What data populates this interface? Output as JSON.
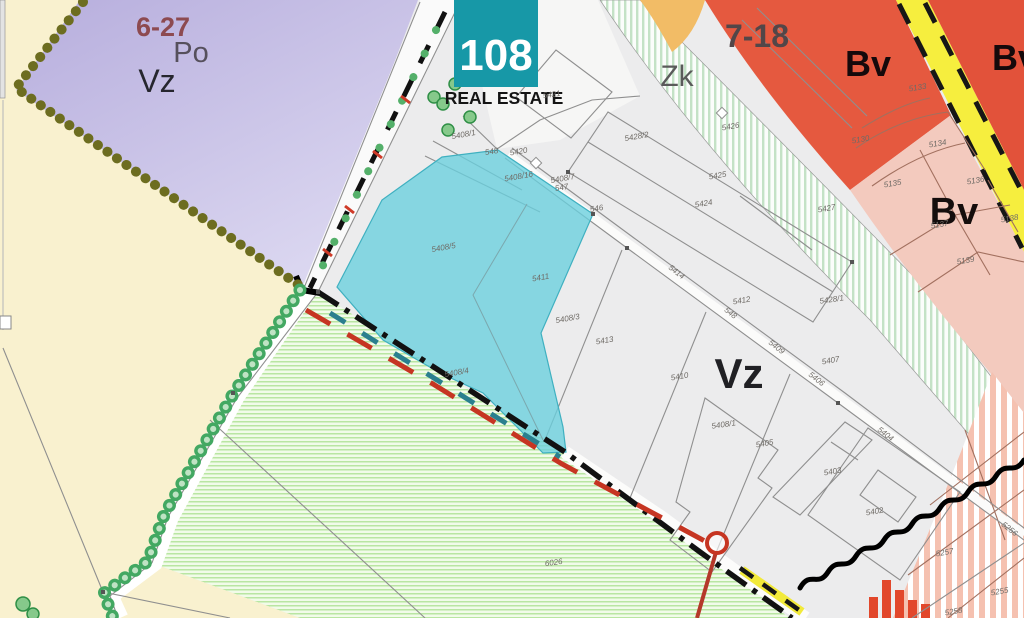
{
  "logo": {
    "number": "108",
    "name": "REAL ESTATE"
  },
  "zone_labels": [
    {
      "id": "zone-label-6-27",
      "text": "6-27",
      "x": 163,
      "y": 36,
      "s": 27,
      "w": 700,
      "c": "#8d4a50"
    },
    {
      "id": "zone-label-po",
      "text": "Po",
      "x": 191,
      "y": 62,
      "s": 29,
      "w": 400,
      "c": "#56505c"
    },
    {
      "id": "zone-label-vz-left",
      "text": "Vz",
      "x": 157,
      "y": 92,
      "s": 32,
      "w": 400,
      "c": "#26262e"
    },
    {
      "id": "zone-label-zk",
      "text": "Zk",
      "x": 677,
      "y": 86,
      "s": 30,
      "w": 400,
      "c": "#5a5a5a"
    },
    {
      "id": "zone-label-7-18",
      "text": "7-18",
      "x": 757,
      "y": 47,
      "s": 32,
      "w": 600,
      "c": "#534648"
    },
    {
      "id": "zone-label-bv-top",
      "text": "Bv",
      "x": 868,
      "y": 76,
      "s": 36,
      "w": 600,
      "c": "#15090b"
    },
    {
      "id": "zone-label-bv-right",
      "text": "Bv",
      "x": 1015,
      "y": 70,
      "s": 36,
      "w": 600,
      "c": "#15090b"
    },
    {
      "id": "zone-label-bv-pink",
      "text": "Bv",
      "x": 954,
      "y": 224,
      "s": 38,
      "w": 600,
      "c": "#140d0c"
    },
    {
      "id": "zone-label-vz-main",
      "text": "Vz",
      "x": 739,
      "y": 388,
      "s": 42,
      "w": 600,
      "c": "#202024"
    }
  ],
  "parcels": [
    {
      "id": "5421",
      "x": 552,
      "y": 97,
      "r": -8
    },
    {
      "id": "5408/1",
      "x": 464,
      "y": 137,
      "r": -10
    },
    {
      "id": "548",
      "x": 492,
      "y": 154,
      "r": -10
    },
    {
      "id": "5420",
      "x": 519,
      "y": 154,
      "r": -10
    },
    {
      "id": "5408/16",
      "x": 519,
      "y": 179,
      "r": -10
    },
    {
      "id": "5408/7",
      "x": 563,
      "y": 181,
      "r": -10
    },
    {
      "id": "547",
      "x": 562,
      "y": 190,
      "r": -10
    },
    {
      "id": "5428/2",
      "x": 637,
      "y": 139,
      "r": -10
    },
    {
      "id": "5426",
      "x": 731,
      "y": 129,
      "r": -10
    },
    {
      "id": "5425",
      "x": 718,
      "y": 178,
      "r": -10
    },
    {
      "id": "5424",
      "x": 704,
      "y": 206,
      "r": -10
    },
    {
      "id": "546",
      "x": 597,
      "y": 211,
      "r": -10
    },
    {
      "id": "5427",
      "x": 827,
      "y": 211,
      "r": -10
    },
    {
      "id": "5133",
      "x": 918,
      "y": 90,
      "r": -10
    },
    {
      "id": "5130",
      "x": 861,
      "y": 142,
      "r": -10
    },
    {
      "id": "5134",
      "x": 938,
      "y": 146,
      "r": -10
    },
    {
      "id": "5135",
      "x": 893,
      "y": 186,
      "r": -10
    },
    {
      "id": "5136",
      "x": 976,
      "y": 183,
      "r": -10
    },
    {
      "id": "5137",
      "x": 940,
      "y": 227,
      "r": -10
    },
    {
      "id": "5138",
      "x": 1010,
      "y": 221,
      "r": -10
    },
    {
      "id": "5139",
      "x": 966,
      "y": 263,
      "r": -10
    },
    {
      "id": "5414",
      "x": 675,
      "y": 274,
      "r": 38
    },
    {
      "id": "5412",
      "x": 742,
      "y": 303,
      "r": -10
    },
    {
      "id": "548",
      "x": 729,
      "y": 315,
      "r": 38
    },
    {
      "id": "5428/1",
      "x": 832,
      "y": 302,
      "r": -8
    },
    {
      "id": "5413",
      "x": 605,
      "y": 343,
      "r": -10
    },
    {
      "id": "5409",
      "x": 775,
      "y": 349,
      "r": 38
    },
    {
      "id": "5410",
      "x": 680,
      "y": 379,
      "r": -10
    },
    {
      "id": "5407",
      "x": 831,
      "y": 363,
      "r": -10
    },
    {
      "id": "5406",
      "x": 815,
      "y": 381,
      "r": 38
    },
    {
      "id": "5408/1",
      "x": 724,
      "y": 427,
      "r": -8
    },
    {
      "id": "5405",
      "x": 765,
      "y": 446,
      "r": -10
    },
    {
      "id": "5404",
      "x": 884,
      "y": 436,
      "r": 38
    },
    {
      "id": "5403",
      "x": 833,
      "y": 474,
      "r": -10
    },
    {
      "id": "5402",
      "x": 875,
      "y": 514,
      "r": -10
    },
    {
      "id": "5256",
      "x": 1008,
      "y": 531,
      "r": 38
    },
    {
      "id": "5257",
      "x": 945,
      "y": 555,
      "r": -10
    },
    {
      "id": "5255",
      "x": 1000,
      "y": 594,
      "r": -10
    },
    {
      "id": "5258",
      "x": 954,
      "y": 614,
      "r": -10
    },
    {
      "id": "5408/5",
      "x": 444,
      "y": 250,
      "r": -10
    },
    {
      "id": "5408/4",
      "x": 457,
      "y": 375,
      "r": -10
    },
    {
      "id": "5411",
      "x": 541,
      "y": 280,
      "r": -10
    },
    {
      "id": "5408/3",
      "x": 568,
      "y": 321,
      "r": -10
    },
    {
      "id": "6026",
      "x": 554,
      "y": 565,
      "r": -8
    }
  ],
  "colors": {
    "logo_teal": "#1798a7",
    "highlight_cyan": "#69cfde",
    "zone_purple": "#bdb5e0",
    "zone_cream": "#f9f1cf",
    "zone_gray": "#ececed",
    "zone_red": "#e5593f",
    "zone_orange": "#f2bc66",
    "zone_pink": "#f3cabe",
    "road_yellow": "#f6ee3e",
    "greenery_ring": "#43a862",
    "hatch_green": "#b9e6a2",
    "boundary_red": "#c63522",
    "dot_olive": "#6d6d20"
  }
}
